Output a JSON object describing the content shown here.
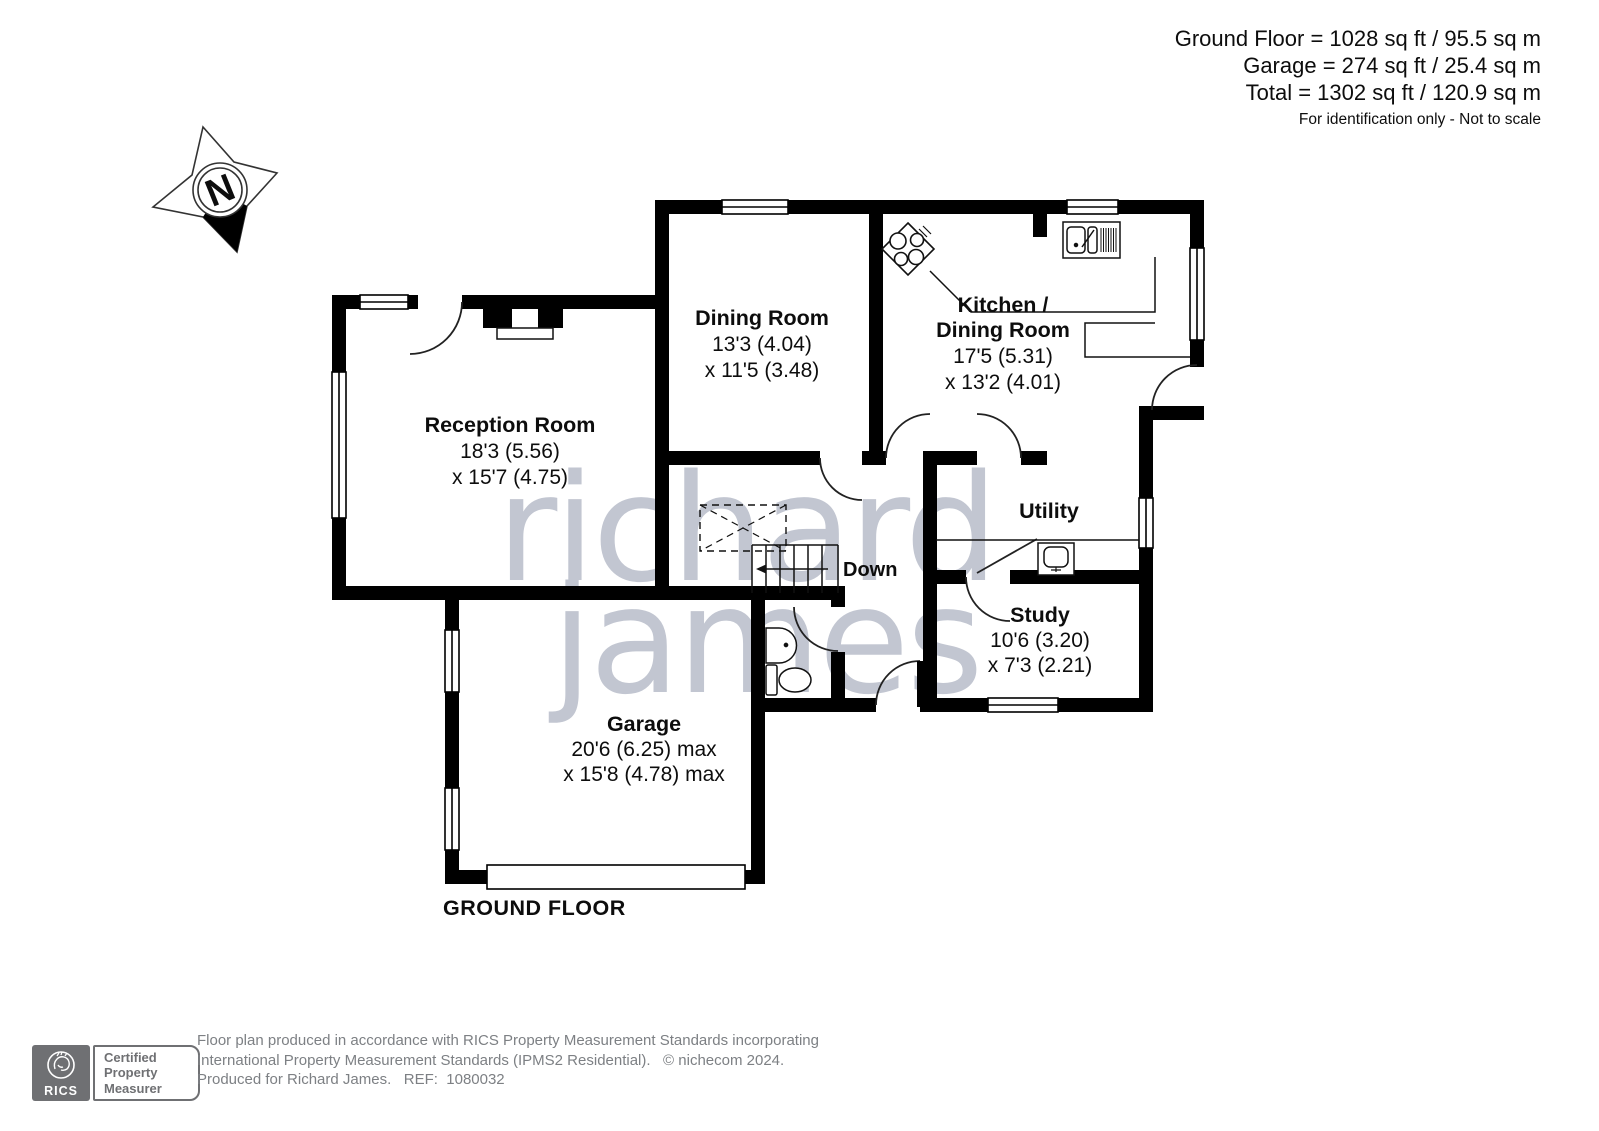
{
  "stats": {
    "line1": "Ground Floor = 1028 sq ft / 95.5 sq m",
    "line2": "Garage = 274 sq ft / 25.4 sq m",
    "line3": "Total = 1302 sq ft / 120.9 sq m",
    "note": "For identification only - Not to scale"
  },
  "compass": {
    "north": "N"
  },
  "watermark": {
    "line1": "richard",
    "line2": "james",
    "color": "#c2c6d1"
  },
  "floor_title": "GROUND FLOOR",
  "rooms": {
    "reception": {
      "name": "Reception Room",
      "dim1": "18'3 (5.56)",
      "dim2": "x 15'7 (4.75)"
    },
    "dining": {
      "name": "Dining Room",
      "dim1": "13'3 (4.04)",
      "dim2": "x 11'5 (3.48)"
    },
    "kitchen": {
      "name1": "Kitchen /",
      "name2": "Dining Room",
      "dim1": "17'5 (5.31)",
      "dim2": "x 13'2 (4.01)"
    },
    "utility": {
      "name": "Utility"
    },
    "study": {
      "name": "Study",
      "dim1": "10'6 (3.20)",
      "dim2": "x 7'3 (2.21)"
    },
    "garage": {
      "name": "Garage",
      "dim1": "20'6 (6.25) max",
      "dim2": "x 15'8 (4.78) max"
    },
    "stairs": {
      "label": "Down"
    }
  },
  "icons": {
    "compass": "north-compass-rose",
    "hob": "cooktop-four-burners",
    "kitchen_sink": "double-sink-with-drainer",
    "utility_sink": "utility-sink",
    "wc_basin": "wash-basin",
    "wc_toilet": "toilet",
    "rics": "rics-lion-mark"
  },
  "colors": {
    "wall": "#000000",
    "watermark": "#c2c6d1",
    "footer_gray": "#6f7073",
    "text_gray": "#7d8084"
  },
  "footer": {
    "rics_logo": "RICS",
    "badge_line1": "Certified",
    "badge_line2": "Property",
    "badge_line3": "Measurer",
    "line1": "Floor plan produced in accordance with RICS Property Measurement Standards incorporating",
    "line2": "International Property Measurement Standards (IPMS2 Residential).   © nichecom 2024.",
    "line3": "Produced for Richard James.   REF:  1080032"
  }
}
